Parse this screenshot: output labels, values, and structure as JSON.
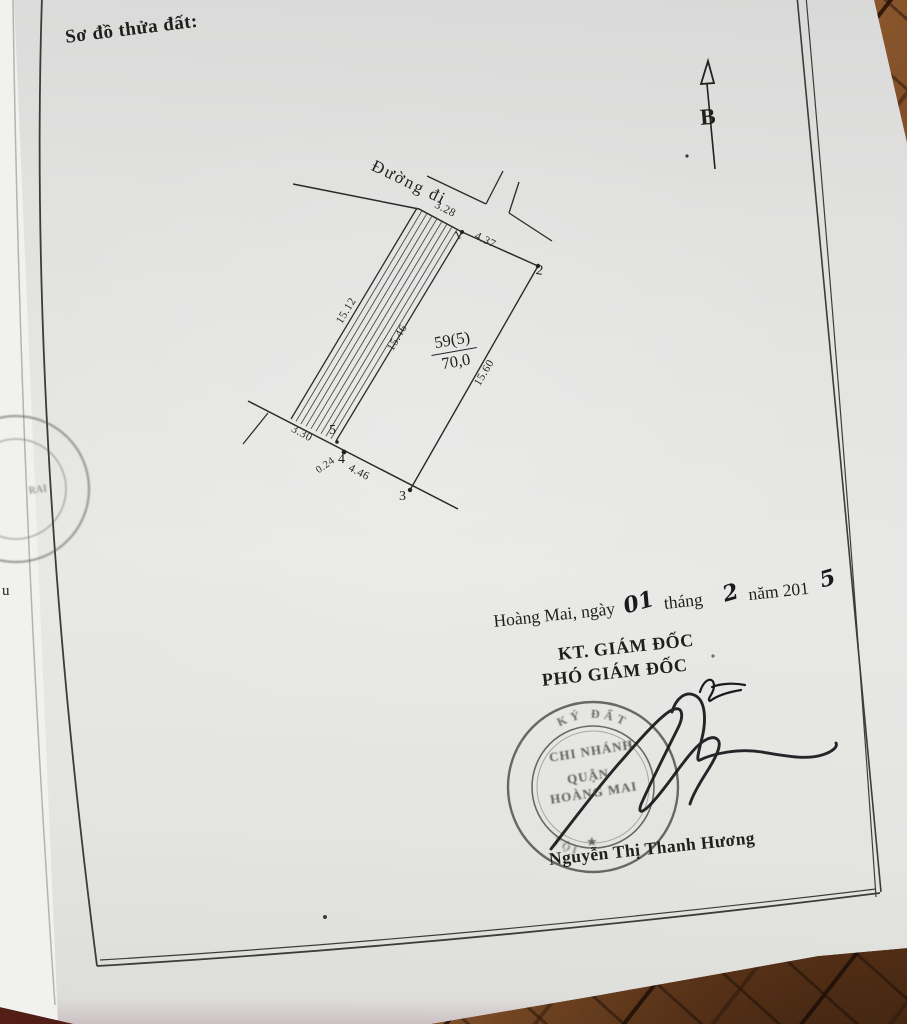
{
  "header": {
    "title": "Sơ đồ thửa đất:"
  },
  "compass": {
    "label": "B"
  },
  "diagram": {
    "road_label": "Đường đi",
    "parcel": {
      "number": "59(5)",
      "area": "70,0"
    },
    "dimensions": {
      "top_strip_width": "3.28",
      "frontage": "4.37",
      "strip_left": "15.12",
      "strip_right": "15.46",
      "right_side": "15.60",
      "bottom_strip_width": "3.30",
      "step": "0.24",
      "bottom_side": "4.46"
    },
    "vertices": [
      "1",
      "2",
      "3",
      "4",
      "5"
    ]
  },
  "signoff": {
    "place_line": {
      "prefix": "Hoàng Mai, ngày",
      "day": "01",
      "month_label": "tháng",
      "month": "2",
      "year_label": "năm 201",
      "year_digit": "5"
    },
    "approver_title": "KT. GIÁM ĐỐC",
    "deputy_title": "PHÓ GIÁM ĐỐC",
    "signer_name": "Nguyễn Thị Thanh Hương"
  },
  "stamp": {
    "ring_top_text": "KÝ ĐẤT",
    "ring_bottom_text": "TỘI",
    "line1": "CHI NHÁNH",
    "line2": "QUẬN",
    "line3": "HOÀNG MAI",
    "star": "★"
  },
  "stray": {
    "left_text": "u",
    "left_stamp_text": "RAI"
  }
}
